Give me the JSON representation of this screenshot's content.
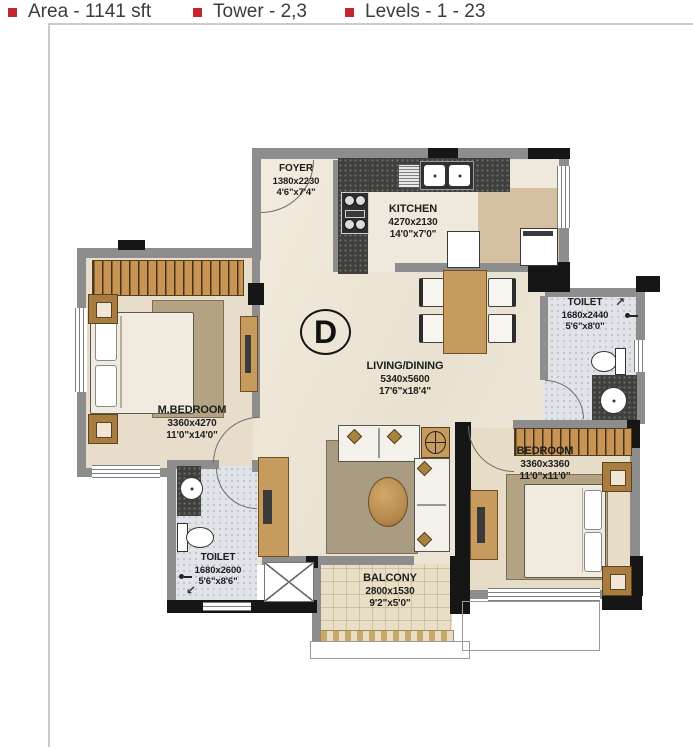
{
  "header": {
    "items": [
      {
        "label": "Area - 1141 sft"
      },
      {
        "label": "Tower - 2,3"
      },
      {
        "label": "Levels - 1 - 23"
      }
    ]
  },
  "unit": {
    "letter": "D"
  },
  "rooms": {
    "foyer": {
      "name": "FOYER",
      "dim_mm": "1380x2230",
      "dim_ft": "4'6\"x7'4\""
    },
    "kitchen": {
      "name": "KITCHEN",
      "dim_mm": "4270x2130",
      "dim_ft": "14'0\"x7'0\""
    },
    "living_dining": {
      "name": "LIVING/DINING",
      "dim_mm": "5340x5600",
      "dim_ft": "17'6\"x18'4\""
    },
    "m_bedroom": {
      "name": "M.BEDROOM",
      "dim_mm": "3360x4270",
      "dim_ft": "11'0\"x14'0\""
    },
    "bedroom": {
      "name": "BEDROOM",
      "dim_mm": "3360x3360",
      "dim_ft": "11'0\"x11'0\""
    },
    "toilet_top": {
      "name": "TOILET",
      "dim_mm": "1680x2440",
      "dim_ft": "5'6\"x8'0\""
    },
    "toilet_bottom": {
      "name": "TOILET",
      "dim_mm": "1680x2600",
      "dim_ft": "5'6\"x8'6\""
    },
    "balcony": {
      "name": "BALCONY",
      "dim_mm": "2800x1530",
      "dim_ft": "9'2\"x5'0\""
    }
  },
  "icons": {
    "door_swing_ne": "↗",
    "door_swing_sw": "↙"
  },
  "colors": {
    "accent_red": "#c4262e",
    "wall_gray": "#8d8d8d",
    "wall_black": "#161616",
    "wood": "#c79a5e",
    "floor_cream": "#ece5d6",
    "tile_gray": "#e0e4e8",
    "counter_dark": "#3f403d",
    "utility_beige": "#d5c0a1"
  }
}
